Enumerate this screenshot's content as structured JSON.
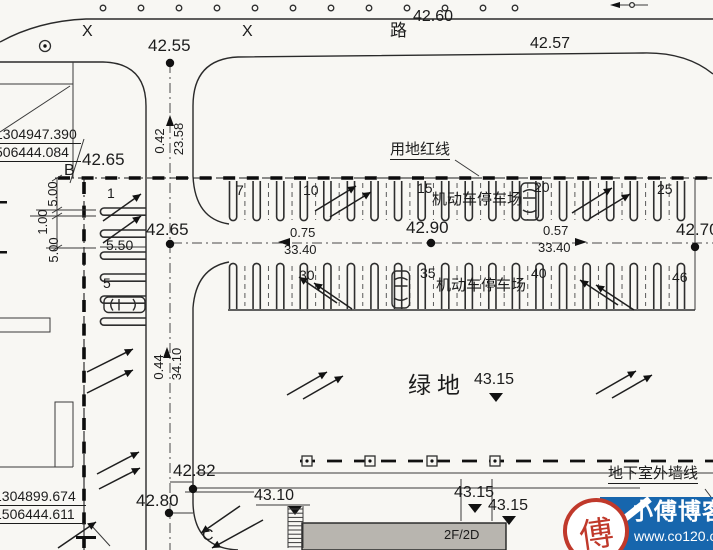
{
  "plan": {
    "road_name": "路",
    "survey_mark": "X",
    "spot_elevations": {
      "road_north": "42.60",
      "road_south_edge": "42.57",
      "intersection_north": "42.55",
      "boundary_b": "42.65",
      "aisle_west": "42.65",
      "aisle_center": "42.90",
      "aisle_east": "42.70",
      "road_west_upper": "42.82",
      "road_west_lower": "42.80",
      "forecourt": "43.10",
      "green_space": "43.15",
      "building_edge_1": "43.15",
      "building_edge_2": "43.15"
    },
    "dimensions": {
      "road_offset_north": "0.42",
      "road_span_north": "23.58",
      "road_offset_west": "0.44",
      "road_span_west": "34.10",
      "setback_top": "5.00",
      "setback_mid": "1.00",
      "setback_bottom": "5.00",
      "stall_depth": "5.50",
      "aisle_offset_west": "0.75",
      "aisle_span_west": "33.40",
      "aisle_offset_east": "0.57",
      "aisle_span_east": "33.40"
    },
    "boundary_points": {
      "b": {
        "label": "B",
        "coord_x": "1304947.390",
        "coord_y": "506444.084"
      },
      "c": {
        "label": "C",
        "coord_x": "1304899.674",
        "coord_y": "1506444.611"
      }
    },
    "annotations": {
      "red_line": "用地红线",
      "parking_top": "机动车停车场",
      "parking_bottom": "机动车停车场",
      "green_space": "绿地",
      "basement_wall": "地下室外墙线",
      "building_floors": "2F/2D"
    },
    "stall_numbers": {
      "left": [
        "1",
        "5"
      ],
      "top": [
        "7",
        "10",
        "15",
        "20",
        "25"
      ],
      "bottom": [
        "30",
        "35",
        "40",
        "46"
      ]
    }
  },
  "watermark": {
    "site_name": "小傅博客",
    "site_url": "www.co120.com",
    "seal_character": "傅",
    "colors": {
      "background": "#1766ad",
      "seal": "#c0392b",
      "text": "#ffffff"
    }
  }
}
